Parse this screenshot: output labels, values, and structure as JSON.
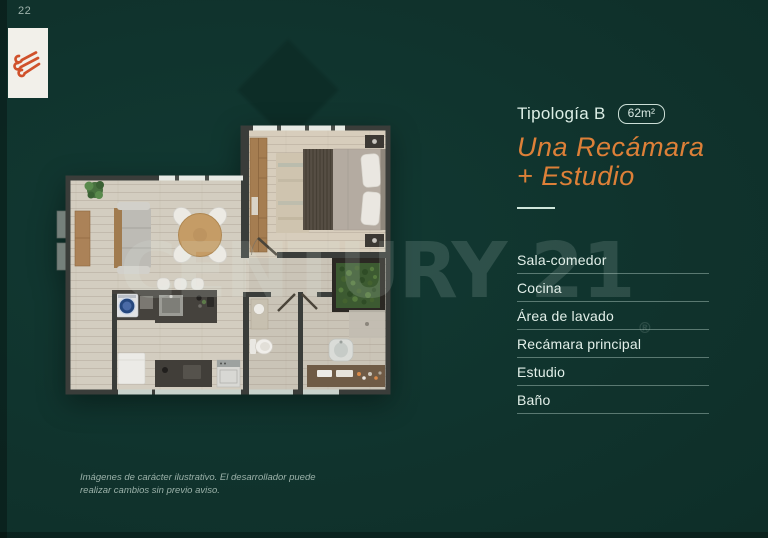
{
  "page": {
    "number": "22"
  },
  "plan_info": {
    "title": "Tipología B",
    "area_badge": "62m²",
    "type_line1": "Una Recámara",
    "type_line2": "+ Estudio"
  },
  "rooms": [
    "Sala-comedor",
    "Cocina",
    "Área de lavado",
    "Recámara principal",
    "Estudio",
    "Baño"
  ],
  "watermark": {
    "brand": "CENTURY 21",
    "symbol": "®"
  },
  "disclaimer": "Imágenes de carácter ilustrativo. El desarrollador puede realizar cambios sin previo aviso.",
  "colors": {
    "background": "#10332d",
    "accent_orange": "#dd8038",
    "panel_text": "#dceee6",
    "logo_orange": "#d0512b",
    "watermark": "rgba(228,242,237,0.14)"
  },
  "icons": {
    "logo": "brand-knot-logo"
  }
}
